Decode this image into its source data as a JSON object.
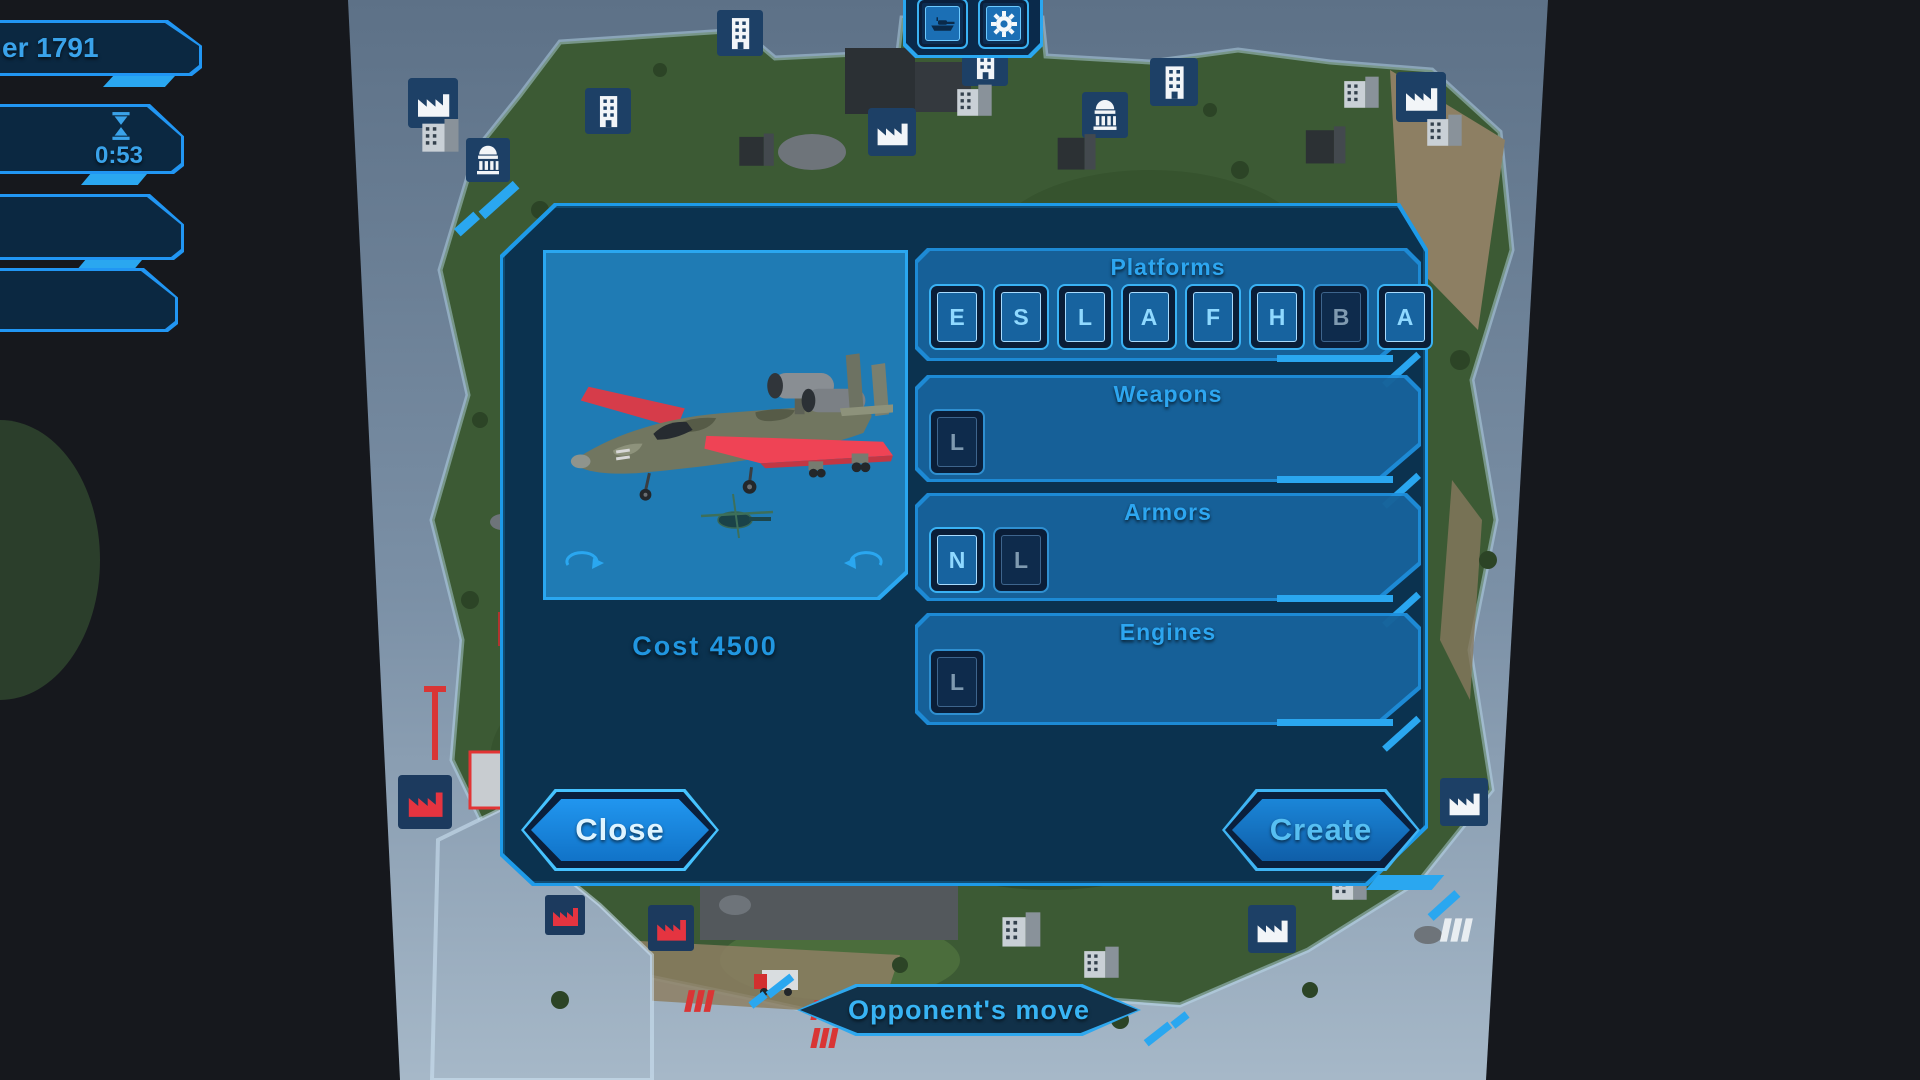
{
  "hud": {
    "player_panel": {
      "text": "er 1791"
    },
    "timer_panel": {
      "time": "0:53",
      "icon": "hourglass-icon"
    },
    "toolbar": {
      "buttons": [
        {
          "id": "units",
          "icon": "tank-icon"
        },
        {
          "id": "settings",
          "icon": "gear-icon"
        }
      ]
    },
    "status_banner": {
      "text": "Opponent's move"
    }
  },
  "dialog": {
    "preview": {
      "model": "attack-aircraft",
      "rotate_left_icon": "rotate-ccw-arrow",
      "rotate_right_icon": "rotate-cw-arrow"
    },
    "cost": {
      "label": "Cost",
      "value": "4500"
    },
    "sections": [
      {
        "title": "Platforms",
        "buttons": [
          {
            "label": "E",
            "state": "available"
          },
          {
            "label": "S",
            "state": "available"
          },
          {
            "label": "L",
            "state": "available"
          },
          {
            "label": "A",
            "state": "available"
          },
          {
            "label": "F",
            "state": "available"
          },
          {
            "label": "H",
            "state": "available"
          },
          {
            "label": "B",
            "state": "selected"
          },
          {
            "label": "A",
            "state": "available"
          }
        ]
      },
      {
        "title": "Weapons",
        "buttons": [
          {
            "label": "L",
            "state": "selected"
          }
        ]
      },
      {
        "title": "Armors",
        "buttons": [
          {
            "label": "N",
            "state": "available"
          },
          {
            "label": "L",
            "state": "selected"
          }
        ]
      },
      {
        "title": "Engines",
        "buttons": [
          {
            "label": "L",
            "state": "selected"
          }
        ]
      }
    ],
    "close_button": "Close",
    "create_button": "Create"
  },
  "colors": {
    "accent": "#2aa7f0",
    "dialog_border": "#1e9be9",
    "section_title": "#2da6f0",
    "button_letter_bright": "#8fd9ff",
    "button_letter_dim": "#7f9ab0",
    "close_text": "#dff4ff",
    "create_text": "#56bff2",
    "banner_text": "#38b4f4",
    "hud_text": "#3aa3ea",
    "cost_text": "#2196e0",
    "water": "#7b90a6",
    "island": "#3c5a34",
    "enemy_red": "#d93535"
  }
}
